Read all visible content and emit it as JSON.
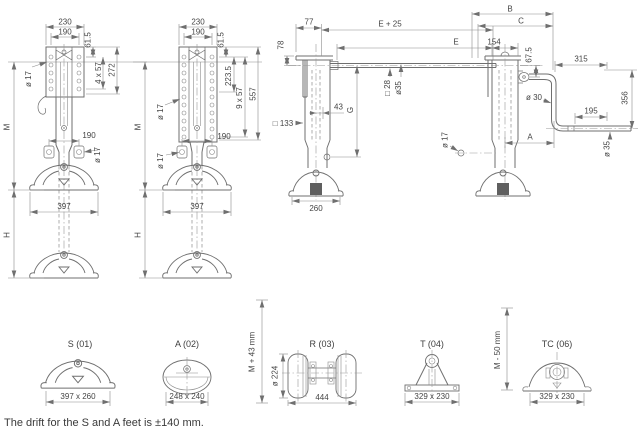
{
  "caption": "The drift for the S and A feet is ±140 mm.",
  "colors": {
    "background": "#ffffff",
    "line": "#6f6f6f",
    "thin_line": "#8c8c8c",
    "text": "#454545"
  },
  "views": {
    "front_crank": {
      "dims": {
        "bracket_width": "230",
        "bolt_spacing": "190",
        "top_offset": "61.5",
        "hole_pattern": "4 x 57",
        "bracket_height": "272",
        "hole_dia": "ø 17",
        "mount_height": "M",
        "lower_bolt_spacing": "190",
        "lower_hole_dia": "ø 17",
        "foot_width": "397",
        "lift": "H"
      }
    },
    "front_plain": {
      "dims": {
        "bracket_width": "230",
        "bolt_spacing": "190",
        "top_offset": "61.5",
        "upper_span": "223.5",
        "hole_pattern": "9 x 57",
        "bracket_height": "557",
        "hole_dia": "ø 17",
        "mount_height": "M",
        "lower_bolt_spacing": "190",
        "lower_hole_dia": "ø 17",
        "foot_width": "397",
        "lift": "H"
      }
    },
    "side_plain": {
      "dims": {
        "front_offset": "77",
        "top_offset": "78",
        "shaft_plus": "E + 25",
        "shaft": "E",
        "shaft_square": "□ 28",
        "shaft_dia": "ø35",
        "leg_offset": "43",
        "extension": "G",
        "tube_size": "□ 133",
        "foot_depth": "260"
      }
    },
    "side_crank": {
      "dims": {
        "dim_b": "B",
        "dim_c": "C",
        "leg_depth": "154",
        "crank_offset": "67.5",
        "arm_length": "315",
        "tube_dia": "ø 30",
        "grip_length": "195",
        "drop": "356",
        "dim_a": "A",
        "grip_dia": "ø 35",
        "pin_dia": "ø 17"
      }
    }
  },
  "feet": [
    {
      "label": "S (01)",
      "size": "397 x 260"
    },
    {
      "label": "A (02)",
      "size": "248 x 240"
    },
    {
      "label": "R (03)",
      "size": "444",
      "wheel_dia": "ø 224",
      "height_note": "M + 43 mm"
    },
    {
      "label": "T (04)",
      "size": "329 x 230"
    },
    {
      "label": "TC (06)",
      "size": "329 x 230",
      "height_note": "M - 50 mm"
    }
  ]
}
